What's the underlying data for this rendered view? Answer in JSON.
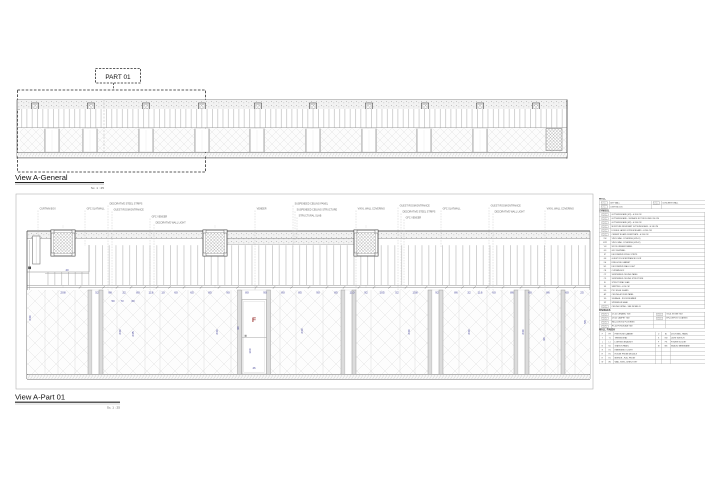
{
  "titles": {
    "part_label": "PART 01",
    "general_view": {
      "title": "View A-General",
      "scale": "Sc. 1 : 25"
    },
    "part_view": {
      "title": "View A-Part 01",
      "scale": "Sc. 1 : 25"
    }
  },
  "colors": {
    "dimension_text": "#4a4a9c",
    "marker_red": "#9e3a38",
    "drawing_line": "#555555",
    "leader_line": "#c2c2c2"
  },
  "main_view": {
    "callouts": [
      {
        "x": 38,
        "y": 209,
        "drop": 236,
        "label": "CURTAIN BOX"
      },
      {
        "x": 85,
        "y": 209,
        "drop": 246,
        "label": "GFC SLATWALL"
      },
      {
        "x": 108,
        "y": 204,
        "drop": 290,
        "label": "DECORATIVE STEEL STRIPS"
      },
      {
        "x": 112,
        "y": 210,
        "drop": 290,
        "label": "GUEST ROOM ENTRANCE"
      },
      {
        "x": 150,
        "y": 217,
        "drop": 290,
        "label": "GFC VENEER"
      },
      {
        "x": 154,
        "y": 223,
        "drop": 290,
        "label": "DECORATIVE WALL LIGHT"
      },
      {
        "x": 255,
        "y": 209,
        "drop": 290,
        "label": "VENEER"
      },
      {
        "x": 293,
        "y": 204,
        "drop": 247,
        "label": "SUSPENDED CEILING PANEL"
      },
      {
        "x": 295,
        "y": 210,
        "drop": 243,
        "label": "SUSPENDED CEILING STRUCTURE"
      },
      {
        "x": 297,
        "y": 216,
        "drop": 238,
        "label": "STRUCTURAL SLAB"
      },
      {
        "x": 356,
        "y": 209,
        "drop": 290,
        "label": "VINYL WALL COVERING"
      },
      {
        "x": 398,
        "y": 206,
        "drop": 290,
        "label": "GUEST ROOM ENTRANCE"
      },
      {
        "x": 401,
        "y": 212,
        "drop": 290,
        "label": "DECORATIVE STEEL STRIPS"
      },
      {
        "x": 404,
        "y": 218,
        "drop": 290,
        "label": "GFC VENEER"
      },
      {
        "x": 441,
        "y": 209,
        "drop": 247,
        "label": "GFC SLATWALL"
      },
      {
        "x": 489,
        "y": 206,
        "drop": 290,
        "label": "GUEST ROOM ENTRANCE"
      },
      {
        "x": 493,
        "y": 212,
        "drop": 290,
        "label": "DECORATIVE WALL LIGHT"
      },
      {
        "x": 545,
        "y": 209,
        "drop": 290,
        "label": "VINYL WALL COVERING"
      }
    ],
    "dim_string": [
      {
        "x": 63,
        "v": "208"
      },
      {
        "x": 97,
        "v": "52"
      },
      {
        "x": 110,
        "v": "98"
      },
      {
        "x": 124,
        "v": "32"
      },
      {
        "x": 138,
        "v": "80"
      },
      {
        "x": 151,
        "v": "116"
      },
      {
        "x": 163,
        "v": "10"
      },
      {
        "x": 176,
        "v": "60"
      },
      {
        "x": 192,
        "v": "65"
      },
      {
        "x": 210,
        "v": "85"
      },
      {
        "x": 228,
        "v": "90"
      },
      {
        "x": 247,
        "v": "80"
      },
      {
        "x": 265,
        "v": "90"
      },
      {
        "x": 283,
        "v": "80"
      },
      {
        "x": 300,
        "v": "85"
      },
      {
        "x": 318,
        "v": "90"
      },
      {
        "x": 336,
        "v": "85"
      },
      {
        "x": 352,
        "v": "110"
      },
      {
        "x": 366,
        "v": "92"
      },
      {
        "x": 382,
        "v": "105"
      },
      {
        "x": 397,
        "v": "52"
      },
      {
        "x": 415,
        "v": "158"
      },
      {
        "x": 437,
        "v": "92"
      },
      {
        "x": 456,
        "v": "86"
      },
      {
        "x": 469,
        "v": "32"
      },
      {
        "x": 480,
        "v": "116"
      },
      {
        "x": 494,
        "v": "60"
      },
      {
        "x": 512,
        "v": "86"
      },
      {
        "x": 530,
        "v": "60"
      },
      {
        "x": 548,
        "v": "86"
      },
      {
        "x": 567,
        "v": "60"
      },
      {
        "x": 582,
        "v": "25"
      }
    ],
    "vertical_dims": [
      {
        "x": 31,
        "y": 318,
        "v": "230"
      },
      {
        "x": 121,
        "y": 332,
        "v": "230"
      },
      {
        "x": 134,
        "y": 334,
        "v": "235"
      },
      {
        "x": 218,
        "y": 332,
        "v": "230"
      },
      {
        "x": 239,
        "y": 328,
        "v": "90"
      },
      {
        "x": 251,
        "y": 351,
        "v": "100"
      },
      {
        "x": 303,
        "y": 331,
        "v": "230"
      },
      {
        "x": 410,
        "y": 332,
        "v": "230"
      },
      {
        "x": 470,
        "y": 332,
        "v": "230"
      },
      {
        "x": 524,
        "y": 332,
        "v": "230"
      },
      {
        "x": 545,
        "y": 339,
        "v": "90"
      },
      {
        "x": 586,
        "y": 322,
        "v": "58"
      }
    ],
    "small_dims": [
      {
        "x": 67,
        "y": 271,
        "v": "40"
      },
      {
        "x": 113,
        "y": 302,
        "v": "50"
      },
      {
        "x": 122,
        "y": 302,
        "v": "73"
      },
      {
        "x": 133,
        "y": 302,
        "v": "60"
      },
      {
        "x": 254,
        "y": 369,
        "v": "46"
      }
    ],
    "fire_marker": {
      "x": 252,
      "y": 322,
      "label": "F"
    }
  },
  "legend": {
    "wall": {
      "title": "WALL",
      "rows": [
        [
          "DRY WALL",
          "CONCRETE WALL"
        ],
        [
          "LIGHT BLOCK",
          ""
        ]
      ]
    },
    "symbol": {
      "title": "SYMBOL",
      "rows": [
        {
          "code": "sw",
          "desc": "GYPSUM BOARD (M1) - H 200 CM"
        },
        {
          "code": "sw",
          "desc": "GYPSUM BOARD - SURFACE NOT INCLUDED 200 CM"
        },
        {
          "code": "sw",
          "desc": "GYPSUM BOARD (M2) - H 240 CM"
        },
        {
          "code": "sw",
          "desc": "MOISTURE RESISTANT GYPSUM BOARD - H 240 CM"
        },
        {
          "code": "sw",
          "desc": "DOUBLE LAYER GYPSUM BOARD - H 240 CM"
        },
        {
          "code": "sw",
          "desc": "CEMENT BOARD SUBSTRATE - H 240 CM"
        },
        {
          "code": "VW",
          "desc": "VINYL WALL COVERING (VW-01)"
        },
        {
          "code": "VW2",
          "desc": "VINYL WALL COVERING (VW-02)"
        },
        {
          "code": "VN",
          "desc": "WOOD VENEER PANEL"
        },
        {
          "code": "GS",
          "desc": "GFC SLATWALL"
        },
        {
          "code": "ST",
          "desc": "DECORATIVE STEEL STRIPS"
        },
        {
          "code": "GE",
          "desc": "GUEST ROOM ENTRANCE DOOR"
        },
        {
          "code": "FH",
          "desc": "FIRE HOSE CABINET"
        },
        {
          "code": "WL",
          "desc": "DECORATIVE WALL LIGHT"
        },
        {
          "code": "CB",
          "desc": "CURTAIN BOX"
        },
        {
          "code": "CP",
          "desc": "SUSPENDED CEILING PANEL"
        },
        {
          "code": "CS",
          "desc": "SUSPENDED CEILING STRUCTURE"
        },
        {
          "code": "SL",
          "desc": "STRUCTURAL SLAB"
        },
        {
          "code": "SK",
          "desc": "SKIRTING - H 10 CM"
        },
        {
          "code": "EG",
          "desc": "PVC EDGE GUARD"
        },
        {
          "code": "AP",
          "desc": "CEILING ACCESS PANEL"
        },
        {
          "code": "SG",
          "desc": "SIGNAGE - ROOM NUMBER"
        },
        {
          "code": "SP",
          "desc": "SPRINKLER HEAD"
        },
        {
          "code": "sw",
          "desc": "CEILING DETAIL - SEE DETAIL 05"
        }
      ]
    },
    "finishes": {
      "title": "FINISHES",
      "rows": [
        [
          "CT-01",
          "CERAMIC TILE",
          "ST-01",
          "STONE TILE"
        ],
        [
          "CP-01",
          "CARPET TILE",
          "EP-01",
          "EPOXY COATING"
        ],
        [
          "WD-01",
          "WOOD FLOORING",
          "",
          ""
        ],
        [
          "PT-01",
          "PORCELAIN TILE",
          "",
          ""
        ]
      ]
    },
    "wall_finish": {
      "title": "WALL FINISH",
      "rows": [
        [
          "F",
          "FH",
          "FIRE HOSE CABINET",
          "D",
          "B1",
          "DOOR BELL PANEL"
        ],
        [
          "T",
          "T1",
          "THERMOSTAT",
          "S",
          "SW",
          "LIGHT SWITCH"
        ],
        [
          "L",
          "L1",
          "LIGHTING BRACKET",
          "P",
          "PS",
          "POWER SOCKET"
        ],
        [
          "N",
          "N1",
          "STATION PANEL",
          "M",
          "MB",
          "SEALED MEMBRANE"
        ],
        [
          "E",
          "E1",
          "EMERGENCY LIGHT",
          "",
          "",
          ""
        ],
        [
          "H",
          "H1",
          "HOUSE PHONE MODULE",
          "",
          "",
          ""
        ],
        [
          "R",
          "R1",
          "MIRROR - FULL FRONT",
          "",
          "",
          ""
        ],
        [
          "W",
          "W1",
          "WALL SIGN - DIRECTORY",
          "",
          "",
          ""
        ]
      ]
    }
  }
}
